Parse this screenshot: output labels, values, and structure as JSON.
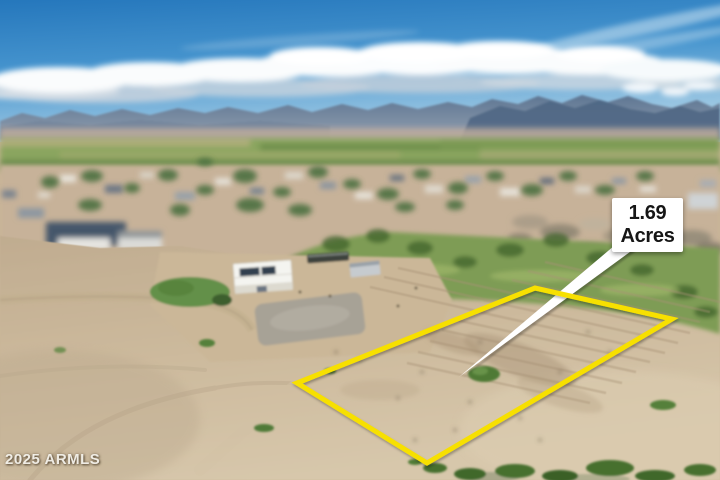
{
  "annotation": {
    "acreage_value": "1.69",
    "acreage_unit": "Acres"
  },
  "watermark": {
    "text": "2025 ARMLS"
  },
  "parcel": {
    "boundary_points": "297,383 535,288 672,319 427,463",
    "pointer_points": "621,240 634,249 459,377",
    "pointer_shadow_points": "623,242 636,251 461,379"
  },
  "colors": {
    "boundary_yellow": "#F7E000",
    "label_background": "#FFFFFF",
    "label_text": "#161616",
    "pointer_white": "#FFFFFF",
    "watermark_text": "#F8F6F0",
    "sky_top": "#2577BC",
    "sky_horizon": "#A9CFE6",
    "mountain": "#5E7693",
    "field_green": "#7E9C54",
    "dirt_tan": "#C9B697"
  }
}
